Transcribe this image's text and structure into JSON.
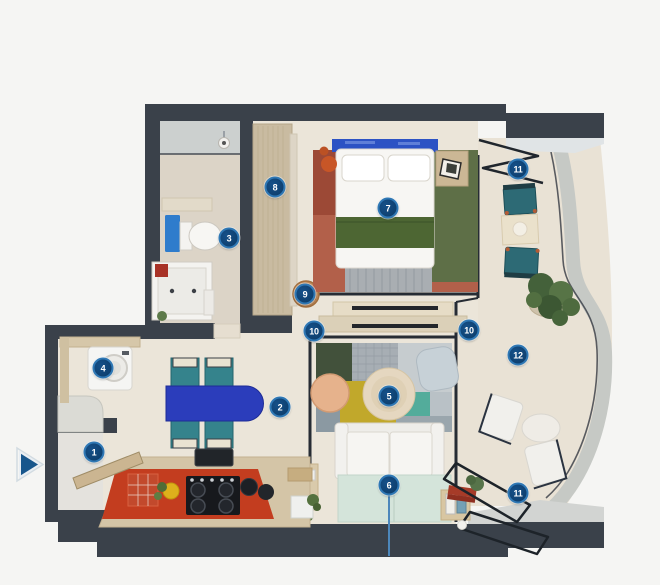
{
  "scene": {
    "description": "3D rendered apartment floor plan with numbered hotspots",
    "background": "#f5f5f3"
  },
  "palette": {
    "wall": "#3a414a",
    "floor": "#ebe5d9",
    "bathroom_floor": "#dcd4c7",
    "balcony_floor": "#e9e2d5",
    "curved_wall": "#c6c9c5",
    "marker_fill": "#0d3a66",
    "marker_ring": "#2f78b5",
    "marker_text": "#ffffff",
    "play_button_fill": "#17568c",
    "callout_line": "#4c87bb"
  },
  "markers": [
    {
      "label": "1",
      "x": 94,
      "y": 452
    },
    {
      "label": "2",
      "x": 280,
      "y": 407
    },
    {
      "label": "3",
      "x": 229,
      "y": 238
    },
    {
      "label": "4",
      "x": 103,
      "y": 368
    },
    {
      "label": "5",
      "x": 389,
      "y": 396
    },
    {
      "label": "6",
      "x": 389,
      "y": 485
    },
    {
      "label": "7",
      "x": 388,
      "y": 208
    },
    {
      "label": "8",
      "x": 275,
      "y": 187
    },
    {
      "label": "9",
      "x": 305,
      "y": 294
    },
    {
      "label": "10",
      "x": 314,
      "y": 331
    },
    {
      "label": "10",
      "x": 469,
      "y": 330
    },
    {
      "label": "11",
      "x": 518,
      "y": 169
    },
    {
      "label": "11",
      "x": 518,
      "y": 493
    },
    {
      "label": "12",
      "x": 518,
      "y": 355
    }
  ],
  "play_button": {
    "icon": "play-triangle-icon"
  }
}
